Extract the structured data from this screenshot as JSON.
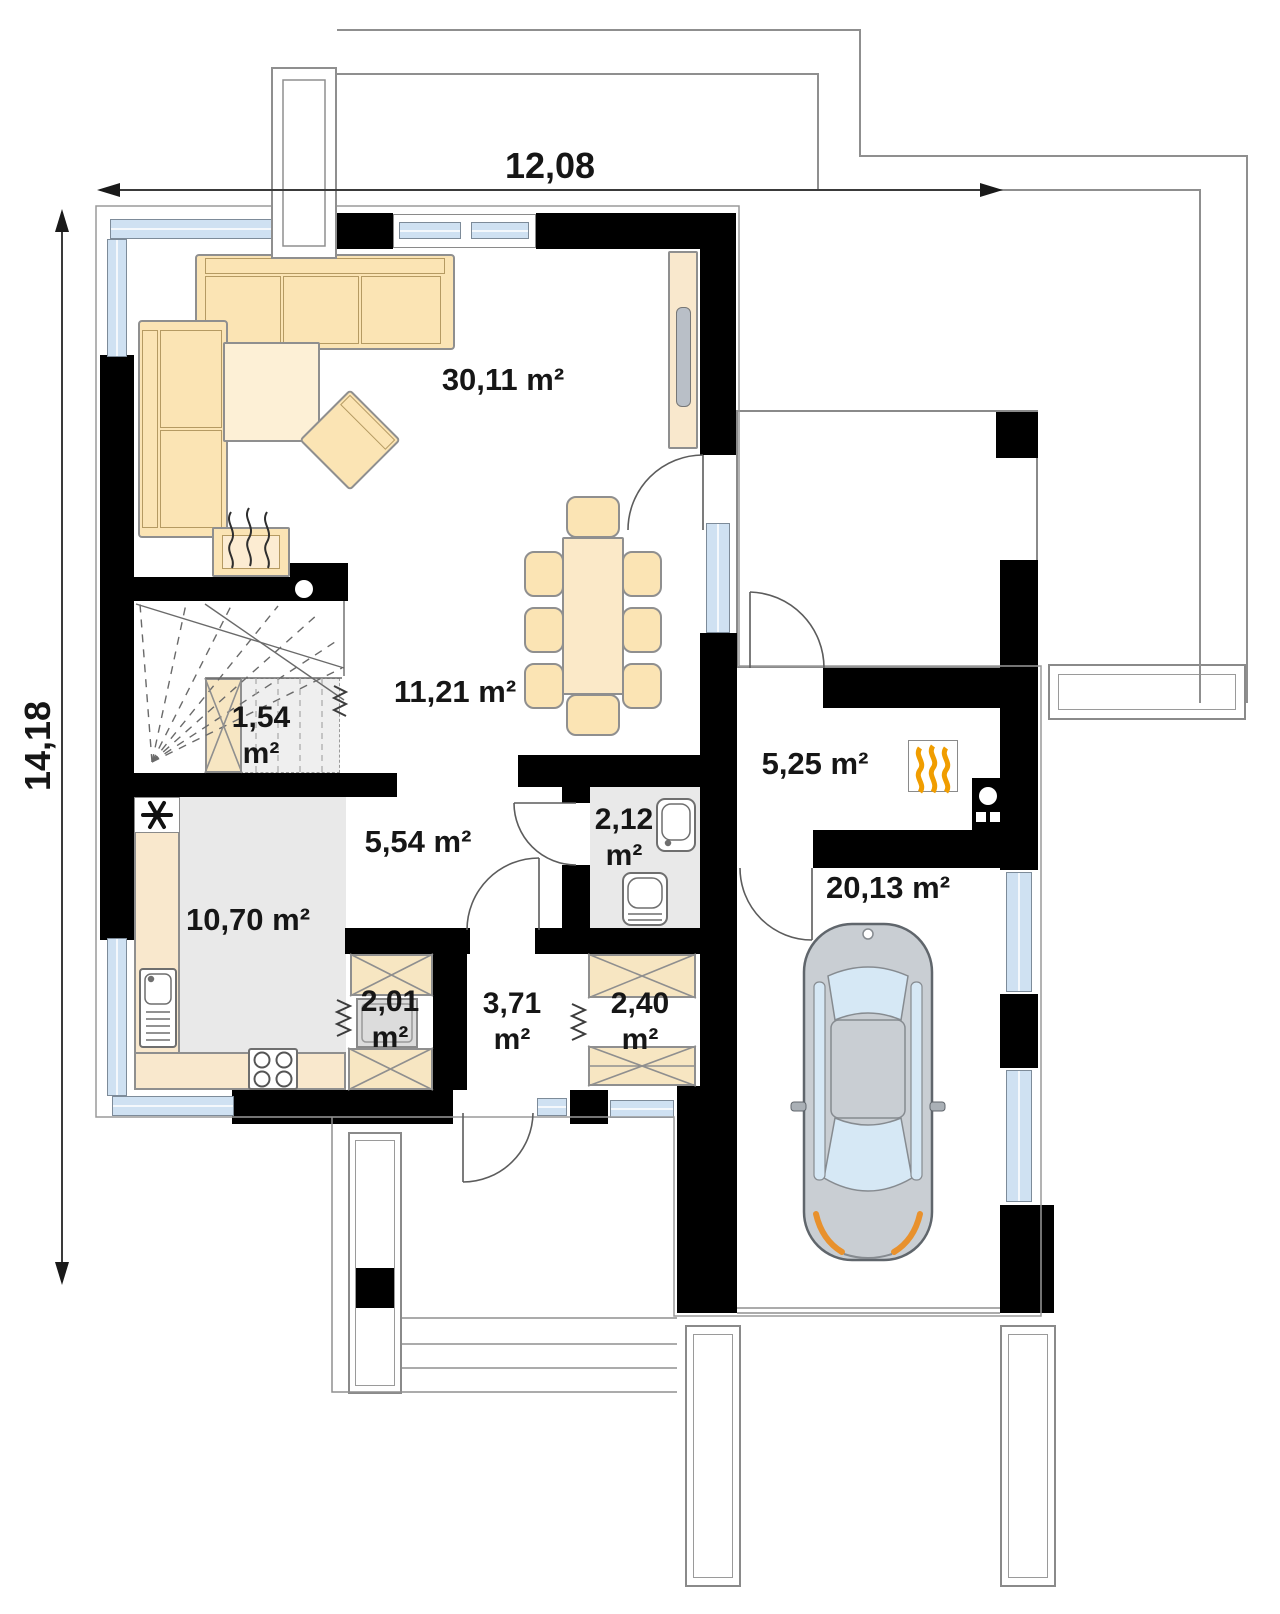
{
  "dimensions": {
    "width_label": "12,08",
    "height_label": "14,18"
  },
  "rooms": {
    "living_room": {
      "area": "30,11 m²"
    },
    "dining_area": {
      "area": "11,21 m²"
    },
    "understairs_storage": {
      "value": "1,54",
      "unit": "m²"
    },
    "hallway": {
      "area": "5,54 m²"
    },
    "kitchen": {
      "area": "10,70 m²"
    },
    "bathroom": {
      "value": "2,12",
      "unit": "m²"
    },
    "boiler_room": {
      "area": "5,25 m²"
    },
    "garage": {
      "area": "20,13 m²"
    },
    "laundry_closet": {
      "value": "2,01",
      "unit": "m²"
    },
    "vestibule": {
      "value": "3,71",
      "unit": "m²"
    },
    "wardrobe": {
      "value": "2,40",
      "unit": "m²"
    }
  },
  "icons": [
    "fridge-snowflake-icon",
    "furnace-flames-icon",
    "boiler-icon",
    "fireplace-icon",
    "stove-burners-icon",
    "sink-icon",
    "toilet-icon",
    "washbasin-icon",
    "car-icon",
    "stairs-icon"
  ],
  "colors": {
    "wall": "#000000",
    "window": "#cfe1f2",
    "furniture": "#fbe4b4",
    "floor": "#e9e9e9",
    "flame": "#f09d00",
    "headlight": "#e8912d",
    "car_body": "#c9ced3",
    "car_window": "#d6e8f5"
  }
}
